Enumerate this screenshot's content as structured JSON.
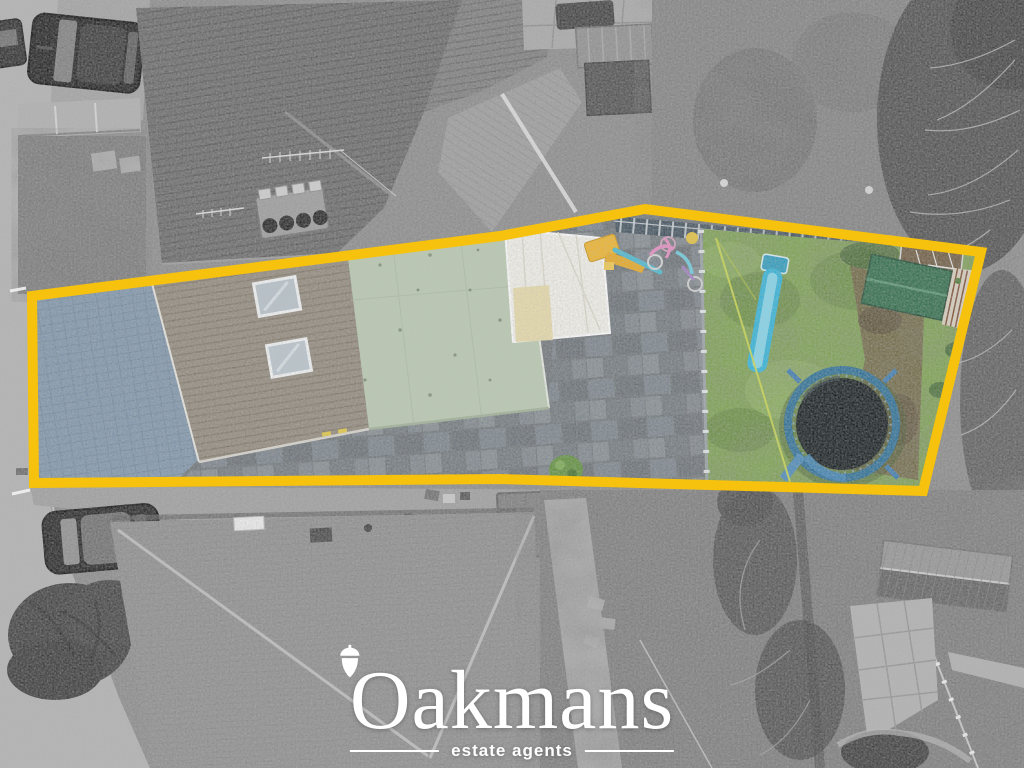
{
  "image": {
    "kind": "aerial drone photograph (top-down)",
    "treatment": "area inside the yellow boundary shown in colour, surroundings desaturated to greyscale"
  },
  "branding": {
    "name": "Oakmans",
    "name_initial": "O",
    "name_rest": "akmans",
    "tagline": "estate agents",
    "logo_icon": "acorn",
    "text_color": "#ffffff"
  },
  "overlay": {
    "color": "#F6C20E",
    "stroke_width": "10",
    "boundary_points": "32,296 500,236 645,209 981,252 923,491 500,479 34,483"
  },
  "scene": {
    "subject": "terraced house plot with driveway, roofs, patio and rear garden",
    "features": {
      "driveway": {
        "label": "blue-grey block-paved driveway",
        "color": "#7E95AB"
      },
      "tiled_roof": {
        "label": "pitched tiled roof with two skylights",
        "color": "#91887B"
      },
      "flat_roof": {
        "label": "pale green flat roof",
        "color": "#B9CAB0"
      },
      "conservatory": {
        "label": "white conservatory roof",
        "color": "#F2F1EA"
      },
      "patio": {
        "label": "grey paved patio with children's toys and bikes",
        "color": "#6E7478"
      },
      "garden": {
        "label": "rear lawn",
        "color": "#7CA24E"
      },
      "slide": {
        "label": "blue children's slide",
        "color": "#2FB3D9"
      },
      "trampoline": {
        "label": "trampoline",
        "mat_color": "#141B1D",
        "rim_color": "#2B6E95"
      },
      "shed": {
        "label": "garden shed with green felt roof",
        "color": "#2E6B49"
      }
    },
    "surroundings": [
      "road",
      "parked cars",
      "neighbouring tiled roofs",
      "chimney stack with pots",
      "tv aerials",
      "rear gardens",
      "bare winter trees",
      "garden sheds",
      "paved paths",
      "hedges"
    ]
  }
}
